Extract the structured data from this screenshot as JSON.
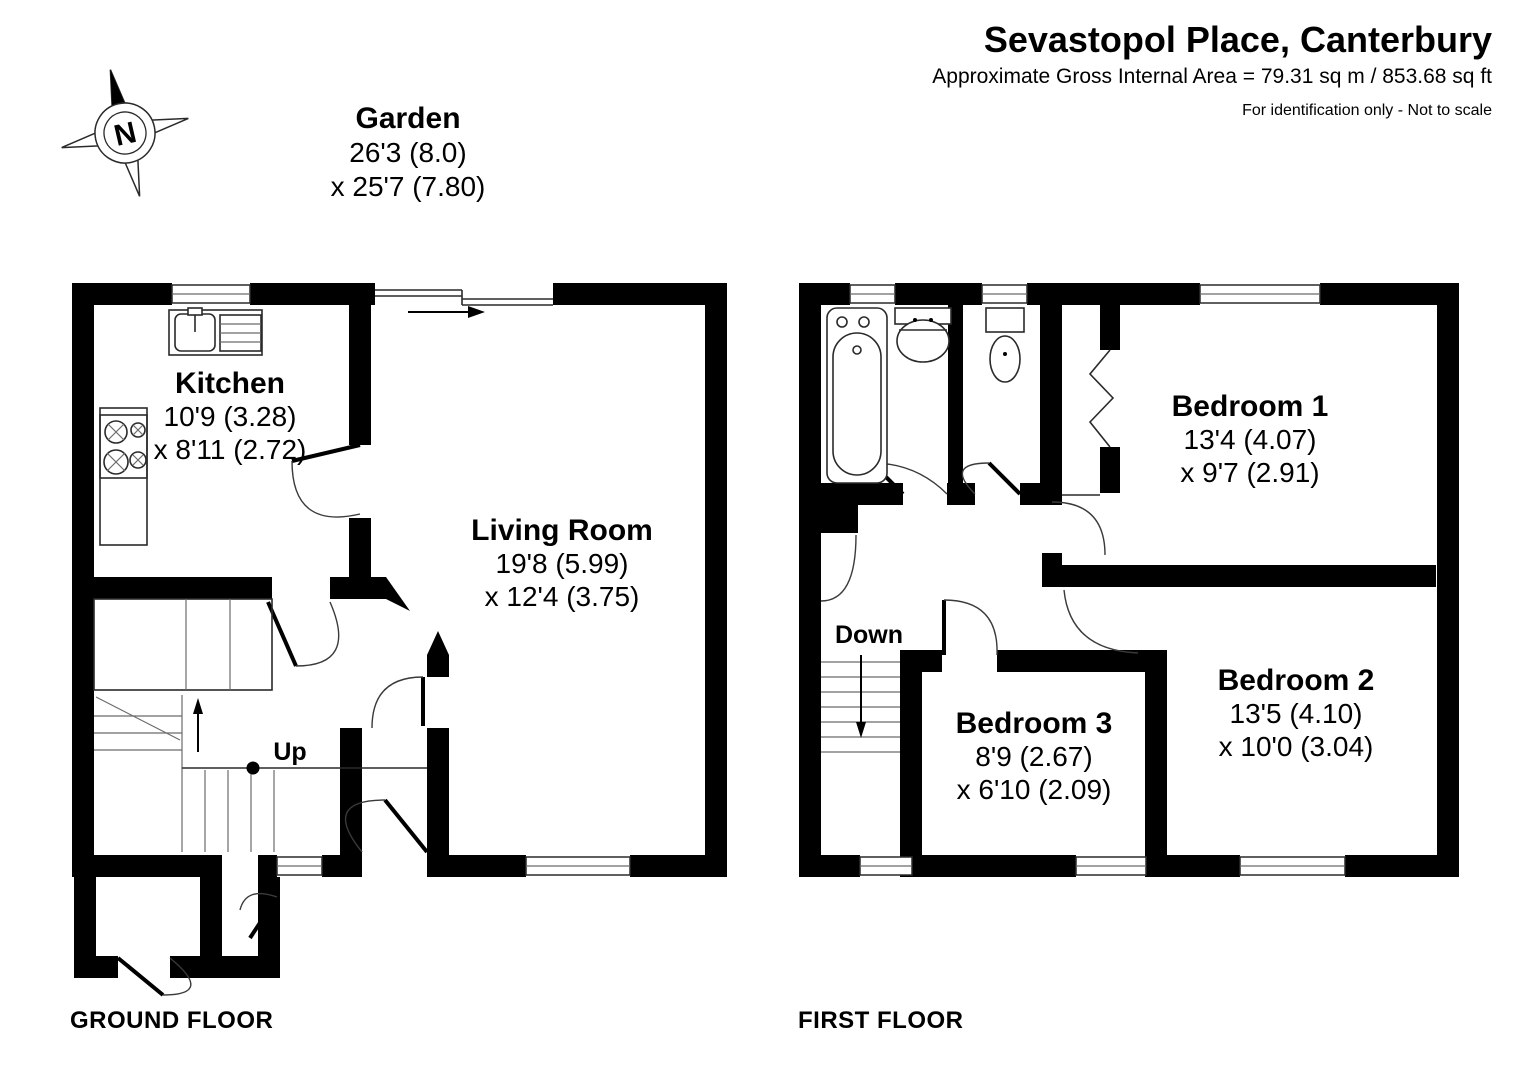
{
  "header": {
    "title": "Sevastopol Place, Canterbury",
    "area": "Approximate Gross Internal Area = 79.31 sq m / 853.68 sq ft",
    "disclaimer": "For identification only - Not to scale"
  },
  "compass": {
    "north": "N"
  },
  "garden": {
    "name": "Garden",
    "dim1": "26'3 (8.0)",
    "dim2": "x 25'7 (7.80)"
  },
  "floors": [
    {
      "label": "GROUND FLOOR",
      "stair_label": "Up",
      "rooms": [
        {
          "name": "Kitchen",
          "dim1": "10'9 (3.28)",
          "dim2": "x 8'11 (2.72)"
        },
        {
          "name": "Living Room",
          "dim1": "19'8 (5.99)",
          "dim2": "x 12'4 (3.75)"
        }
      ]
    },
    {
      "label": "FIRST FLOOR",
      "stair_label": "Down",
      "rooms": [
        {
          "name": "Bedroom 1",
          "dim1": "13'4 (4.07)",
          "dim2": "x 9'7 (2.91)"
        },
        {
          "name": "Bedroom 2",
          "dim1": "13'5 (4.10)",
          "dim2": "x 10'0 (3.04)"
        },
        {
          "name": "Bedroom 3",
          "dim1": "8'9 (2.67)",
          "dim2": "x 6'10 (2.09)"
        }
      ]
    }
  ],
  "colors": {
    "wall": "#000000",
    "line": "#3a3a3a",
    "background": "#ffffff"
  }
}
